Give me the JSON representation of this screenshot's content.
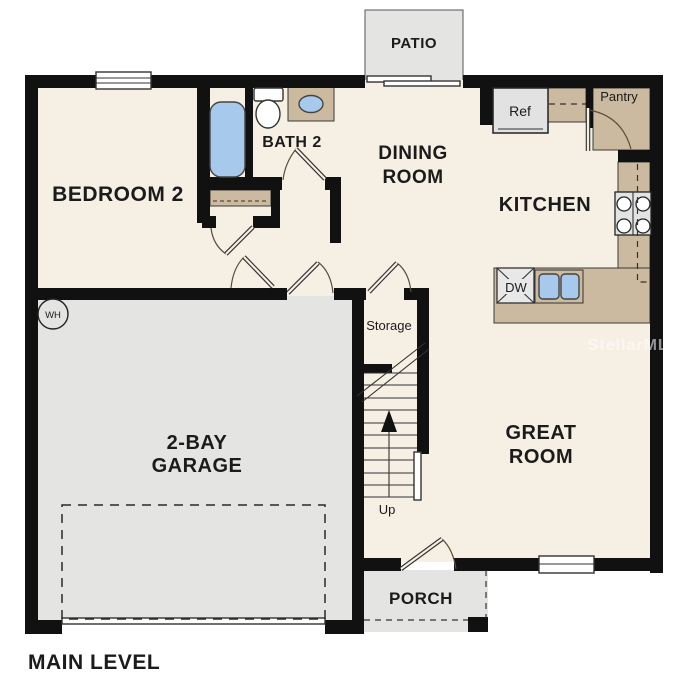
{
  "floor_plan": {
    "level_label": "MAIN LEVEL",
    "watermark": "StellarMLS",
    "rooms": {
      "bedroom2": "BEDROOM 2",
      "bath2": "BATH 2",
      "dining_line1": "DINING",
      "dining_line2": "ROOM",
      "kitchen": "KITCHEN",
      "great_line1": "GREAT",
      "great_line2": "ROOM",
      "garage_line1": "2-BAY",
      "garage_line2": "GARAGE",
      "patio": "PATIO",
      "porch": "PORCH",
      "storage": "Storage"
    },
    "fixtures": {
      "refrigerator": "Ref",
      "pantry": "Pantry",
      "dishwasher": "DW",
      "water_heater": "WH",
      "stairs_direction": "Up"
    },
    "colors": {
      "wall": "#111111",
      "floor": "#f6efe4",
      "garage_floor": "#e4e4e2",
      "counter": "#cbb9a0",
      "fixture_blue": "#a6c9ec"
    }
  }
}
